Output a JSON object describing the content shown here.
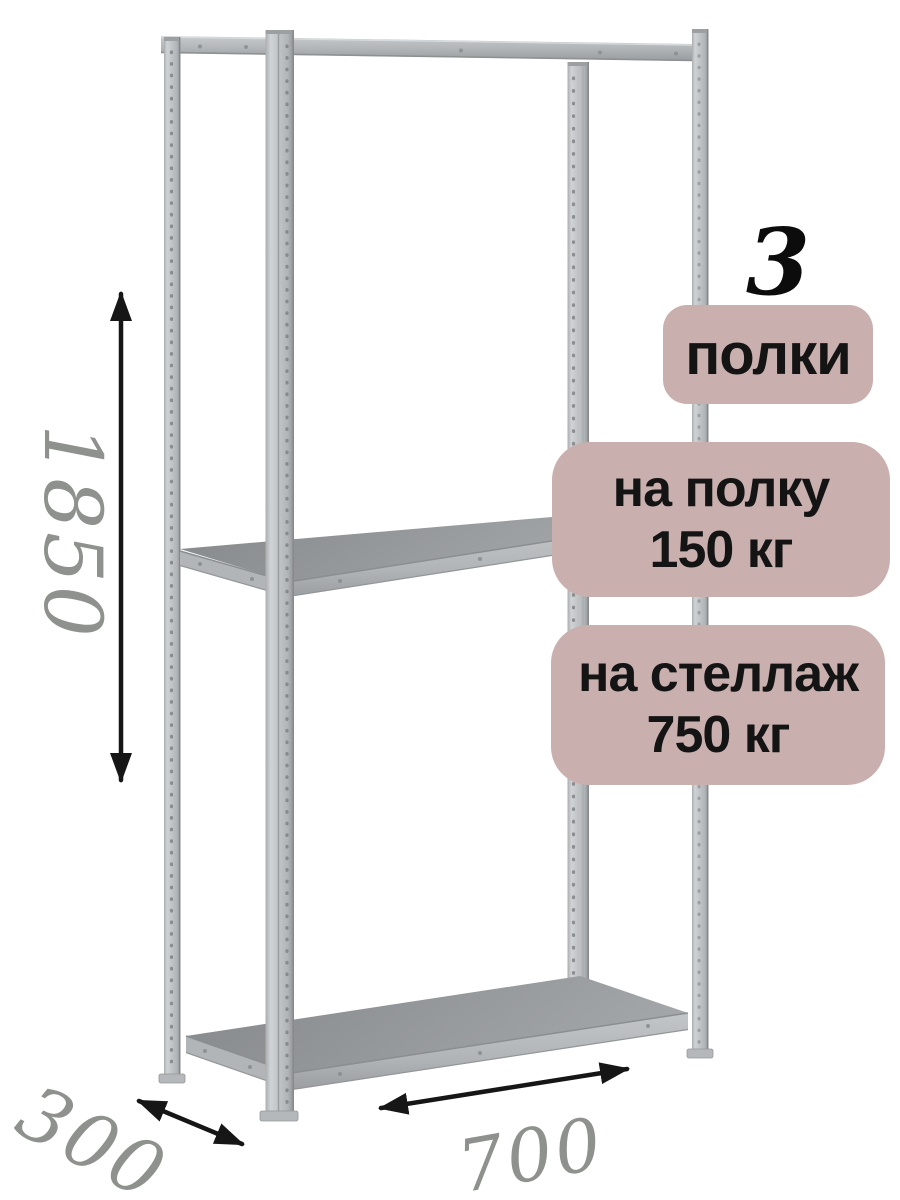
{
  "callouts": {
    "shelf_count": "3",
    "shelf_count_label": "полки",
    "shelf_load": {
      "line1": "на полку",
      "line2": "150 кг"
    },
    "rack_load": {
      "line1": "на стеллаж",
      "line2": "750 кг"
    }
  },
  "dimensions": {
    "height_mm": "1850",
    "depth_mm": "300",
    "width_mm": "700"
  },
  "colors": {
    "badge_bg": "#c9b0ae",
    "badge_text": "#141414",
    "dimension_text": "#8e918e",
    "arrow": "#161616",
    "metal_light": "#c6c9cb",
    "metal_dark": "#8f9294",
    "shelf_top": "#94979a",
    "background": "#ffffff"
  }
}
